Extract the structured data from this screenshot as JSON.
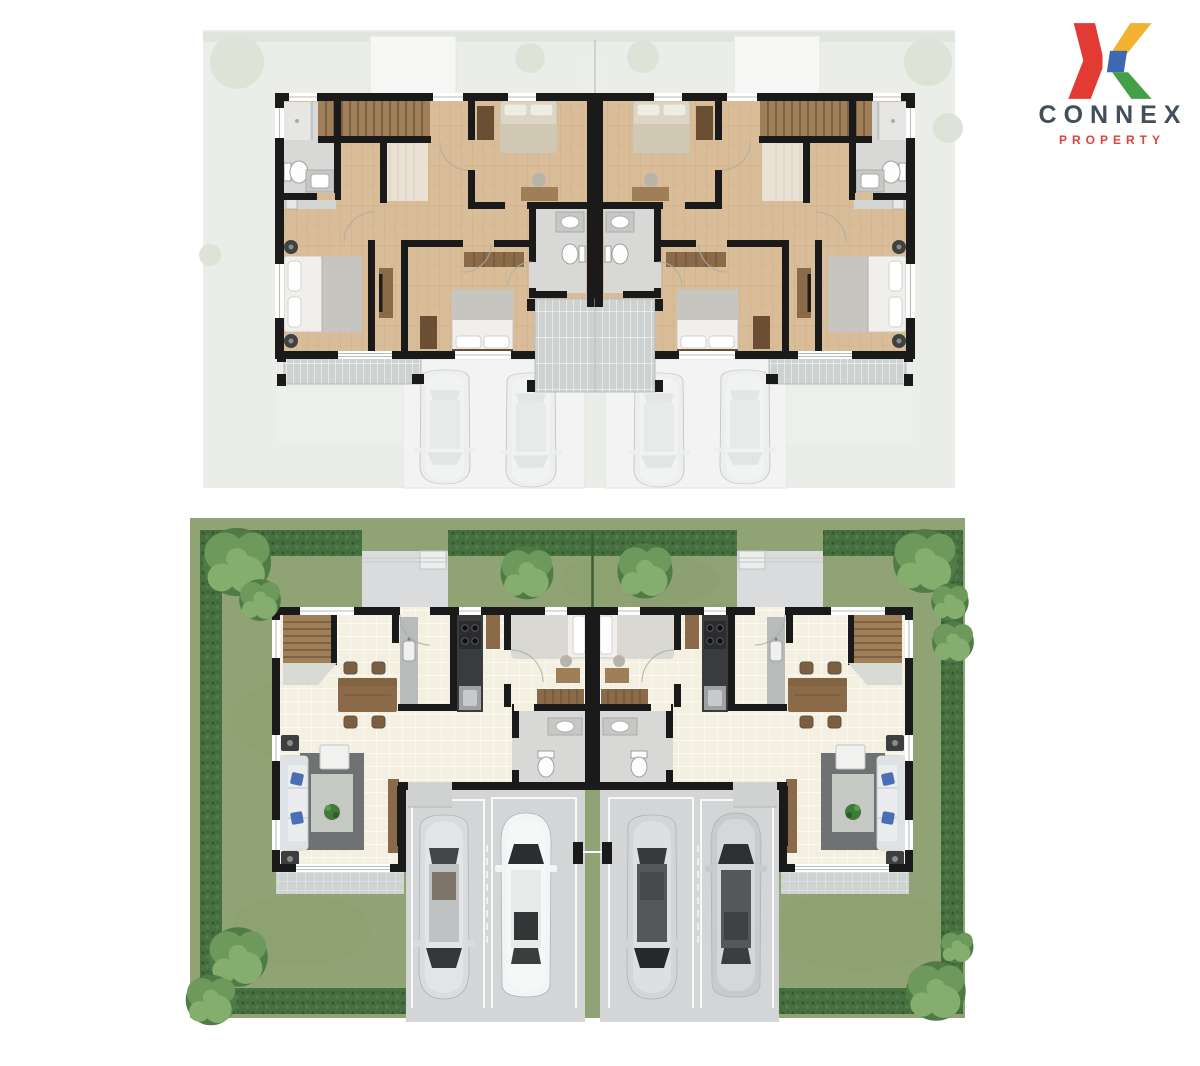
{
  "logo": {
    "brand": "CONNEX",
    "tagline": "PROPERTY",
    "brand_color": "#434e59",
    "tagline_color": "#e2403a",
    "x_colors": {
      "red": "#e23b34",
      "yellow": "#f2b12f",
      "blue": "#3e68b0",
      "green": "#43a047"
    }
  },
  "plans": {
    "second_floor": {
      "name": "second-floor-plan",
      "style": "faded backdrop, wood flooring",
      "units": 2,
      "mirrored": true,
      "rooms_per_unit": [
        "hallway",
        "bathroom-1",
        "stairs",
        "bedroom-3",
        "bathroom-2",
        "master-bedroom",
        "bedroom-2",
        "master-balcony",
        "center-balcony"
      ],
      "furniture_per_unit": [
        "king-bed",
        "double-bed",
        "single-bed",
        "wardrobe",
        "closet-row",
        "desk",
        "tv-cabinet",
        "toilet",
        "vanity",
        "shower",
        "nightstands"
      ],
      "ghost_cars": 4
    },
    "first_floor": {
      "name": "first-floor-plan",
      "style": "site plan with lawn, hedges, trees",
      "units": 2,
      "mirrored": true,
      "rooms_per_unit": [
        "living-room",
        "dining-area",
        "kitchen",
        "maid-room",
        "bathroom",
        "garage",
        "terrace",
        "back-porch",
        "stairs"
      ],
      "furniture_per_unit": [
        "sofa",
        "blue-pillows",
        "coffee-table",
        "area-rug",
        "plant",
        "tv-cabinet",
        "dining-table",
        "dining-chairs",
        "sink-counter",
        "stove-unit",
        "fridge-cabinet",
        "single-bed",
        "desk",
        "dresser",
        "toilet",
        "sink"
      ],
      "cars": 4,
      "trees": 11
    }
  },
  "colors": {
    "wall": "#1a1a1a",
    "backdrop2f": "#eaede8",
    "ghost_white": "#f6f7f4",
    "ghost_drive": "#f2f3f2",
    "ghost_line": "#e2e5e0",
    "faint_tree": "#dde3d7",
    "wood": "#d9bc98",
    "wood_line": "#c2a078",
    "bath_floor": "#d8d9d7",
    "shower_floor": "#e6e7e5",
    "fixture": "#fdfdfc",
    "fixture_stroke": "#9aa09e",
    "cabinet": "#8a6a48",
    "dark_wood": "#6b4f35",
    "stair": "#9f7f58",
    "stair_line": "#5d452f",
    "bed_white": "#f0efec",
    "blanket": "#c7c5c0",
    "bed_beige": "#ddd5c5",
    "hatch_bg": "#cdd1cf",
    "grass": "#90a374",
    "grass_dark": "#7d9162",
    "hedge": "#46703f",
    "tree_dark": "#4f7b46",
    "tree_mid": "#6d9a5c",
    "tree_light": "#85ad6e",
    "tile": "#f3f0e1",
    "garage": "#d4d5d7",
    "porch": "#d9dbdd",
    "terrace": "#ced2d0",
    "rug": "#6f7173",
    "rug_light": "#c6c8c4",
    "sofa": "#eaecee",
    "pillow_blue": "#4a6fb5",
    "counter": "#b9bbba",
    "kitchen_dark": "#393b3d",
    "kitchen_gray": "#9fa1a2",
    "plant": "#3f7a38",
    "park_line": "#f7f8f8"
  }
}
